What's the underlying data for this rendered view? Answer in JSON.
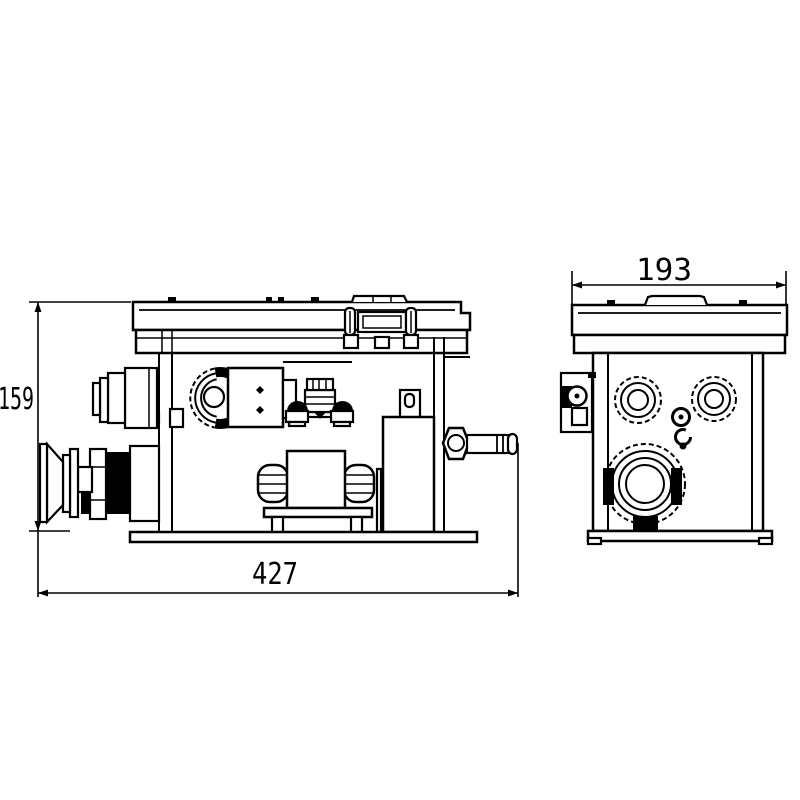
{
  "drawing": {
    "background_color": "#ffffff",
    "line_color": "#000000",
    "dimensions": {
      "side_length": {
        "value": "427"
      },
      "side_height": {
        "value": "159"
      },
      "end_width": {
        "value": "193"
      }
    }
  }
}
